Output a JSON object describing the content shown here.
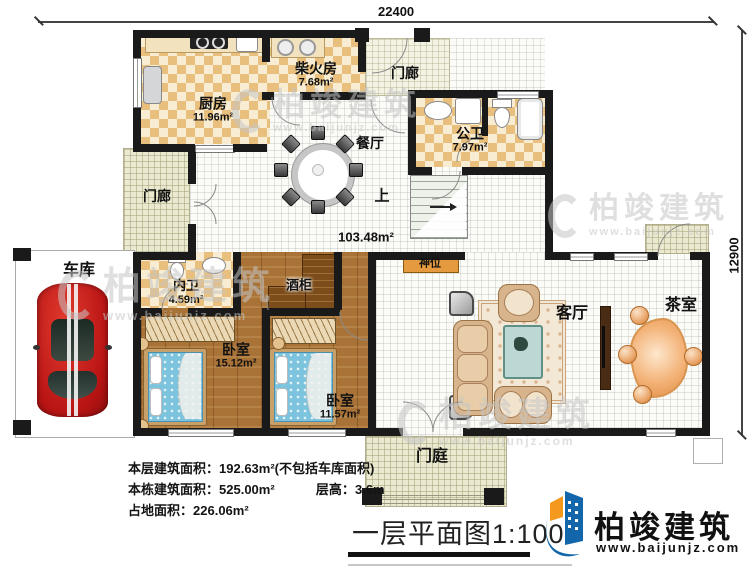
{
  "dimensions": {
    "top": "22400",
    "right": "12900"
  },
  "rooms": {
    "kitchen": {
      "label": "厨房",
      "area": "11.96m²"
    },
    "firewood": {
      "label": "柴火房",
      "area": "7.68m²"
    },
    "porch_top": {
      "label": "门廊"
    },
    "public_bath": {
      "label": "公卫",
      "area": "7.97m²"
    },
    "dining": {
      "label": "餐厅"
    },
    "hall": {
      "area": "103.48m²"
    },
    "stairs": {
      "label": "上"
    },
    "shrine": {
      "label": "神位"
    },
    "porch_left": {
      "label": "门廊"
    },
    "garage": {
      "label": "车库"
    },
    "ensuite_bath": {
      "label": "内卫",
      "area": "4.59m²"
    },
    "wine_cabinet": {
      "label": "酒柜"
    },
    "bedroom1": {
      "label": "卧室",
      "area": "15.12m²"
    },
    "bedroom2": {
      "label": "卧室",
      "area": "11.57m²"
    },
    "living": {
      "label": "客厅"
    },
    "tea_room": {
      "label": "茶室"
    },
    "entry_court": {
      "label": "门庭"
    }
  },
  "stats": {
    "line1_label": "本层建筑面积：",
    "line1_value": "192.63m²(不包括车库面积)",
    "line2_label": "本栋建筑面积：",
    "line2_value": "525.00m²",
    "line2b_label": "层高：",
    "line2b_value": "3.6m",
    "line3_label": "占地面积：",
    "line3_value": "226.06m²"
  },
  "title": "一层平面图1:100",
  "brand": {
    "name": "柏竣建筑",
    "url": "www.baijunjz.com"
  },
  "watermark": {
    "name": "柏竣建筑",
    "url": "www.baijunjz.com"
  },
  "colors": {
    "wall": "#1a1a1a",
    "tile_dark": "#e8bf7d",
    "tile_light": "#f8ecd2",
    "wood": "#a97338",
    "shrine_orange": "#e59a3f",
    "brand_blue": "#1266a9",
    "brand_orange": "#f5991e",
    "car_red": "#cf1f1f",
    "bed_blue": "#7cc3dd"
  }
}
